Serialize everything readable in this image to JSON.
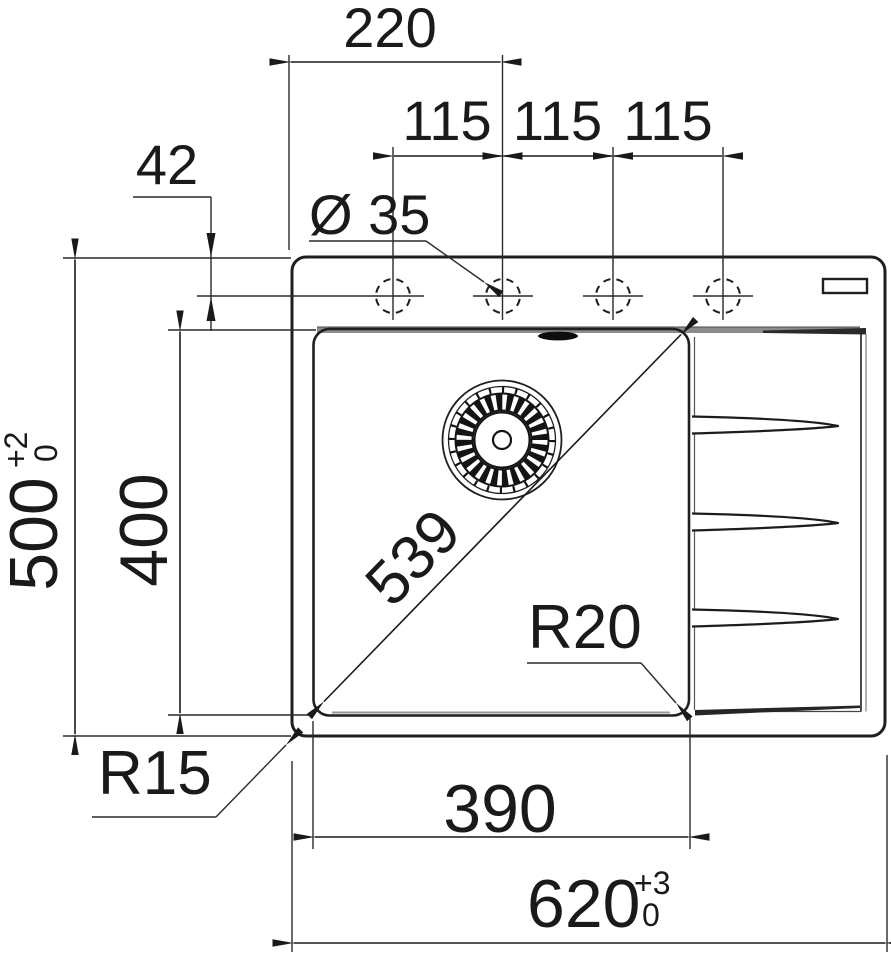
{
  "drawing": {
    "subject": "sink-cutout-dimension-drawing-top-view",
    "colors": {
      "line": "#1f1f1f",
      "rim_shade": "#8c8c8c",
      "background": "#ffffff"
    },
    "labels": {
      "top_width": "220",
      "pitch1": "115",
      "pitch2": "115",
      "pitch3": "115",
      "hole_offset": "42",
      "hole_dia": "Ø 35",
      "depth": {
        "value": "500",
        "tol_plus": "+2",
        "tol_minus": "0"
      },
      "bowl_length": "400",
      "diagonal": "539",
      "bowl_radius": "R20",
      "corner_radius": "R15",
      "bowl_width": "390",
      "overall_width": {
        "value": "620",
        "tol_plus": "+3",
        "tol_minus": "0"
      }
    }
  }
}
